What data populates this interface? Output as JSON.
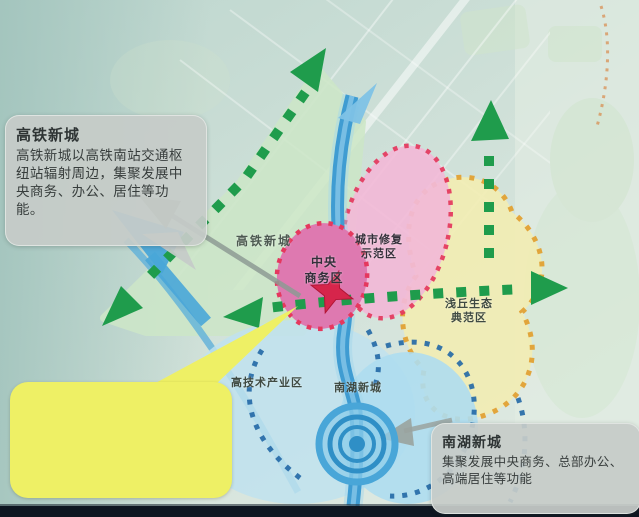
{
  "callouts": {
    "hsr": {
      "title": "高铁新城",
      "body": "高铁新城以高铁南站交通枢纽站辐射周边，集聚发展中央商务、办公、居住等功能。"
    },
    "nanhu": {
      "title": "南湖新城",
      "body": "集聚发展中央商务、总部办公、高端居住等功能"
    },
    "yellow_note": {
      "text": ""
    }
  },
  "zones": {
    "cbd": {
      "line1": "中央",
      "line2": "商务区"
    },
    "repair": {
      "line1": "城市修复",
      "line2": "示范区"
    },
    "eco": {
      "line1": "浅丘生态",
      "line2": "典范区"
    },
    "hsr_axis": {
      "line1": "高铁新城"
    },
    "hightech": {
      "line1": "高技术产业区"
    },
    "nanhu": {
      "line1": "南湖新城"
    }
  },
  "colors": {
    "cbd_zone": "#de79b0",
    "repair_zone": "#f2bad7",
    "eco_zone": "#f1edb5",
    "hsr_zone": "#cde6c8",
    "hightech_zone": "#bfe2ee",
    "nanhu_zone": "#aeddf0",
    "river_blue": "#3f9cd2",
    "arrow_green": "#1f9c4c",
    "border_red_dots": "#e5385e",
    "border_orange_dots": "#e2a233",
    "border_blue_dots": "#2268a6",
    "callout_gray": "#c6cbc9",
    "note_yellow": "#eef065",
    "star_red": "#d6254b"
  }
}
